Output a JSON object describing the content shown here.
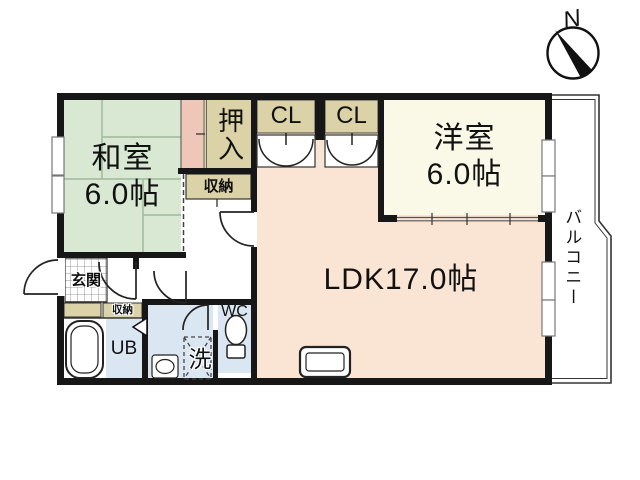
{
  "compass": {
    "north_label": "N"
  },
  "rooms": {
    "washitsu": {
      "name": "和室",
      "size": "6.0帖"
    },
    "youshitsu": {
      "name": "洋室",
      "size": "6.0帖"
    },
    "ldk": {
      "label": "LDK17.0帖"
    },
    "balcony": {
      "label": "バルコニー"
    },
    "genkan": {
      "label": "玄関"
    },
    "oshiire": {
      "label": "押入"
    },
    "closet_left": {
      "label": "CL"
    },
    "closet_right": {
      "label": "CL"
    },
    "storage_hall": {
      "label": "収納"
    },
    "storage_entry": {
      "label": "収納"
    },
    "unit_bath": {
      "label": "UB"
    },
    "laundry": {
      "label": "洗"
    },
    "toilet": {
      "label": "WC"
    }
  },
  "colors": {
    "wall_black": "#171717",
    "tatami_green": "#d8e8d2",
    "tokonoma_salmon": "#eec7b8",
    "closet_beige": "#dbd2a8",
    "ldk_peach": "#fae5d5",
    "youshitsu_cream": "#faf8e6",
    "wet_area_blue": "#dae7f3"
  }
}
